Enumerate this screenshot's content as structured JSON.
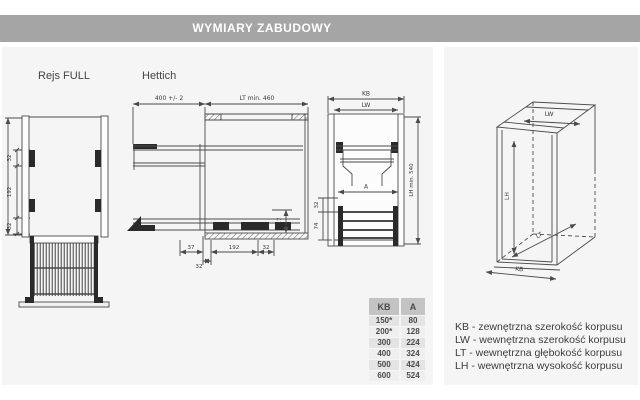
{
  "header": {
    "title": "WYMIARY ZABUDOWY"
  },
  "sections": {
    "left_label": "Rejs FULL",
    "middle_label": "Hettich"
  },
  "dims": {
    "rejs": {
      "v1": "32",
      "v2": "192",
      "v3": "32"
    },
    "side": {
      "extension": "400 +/- 2",
      "depth": "LT min. 460",
      "c1": "37",
      "c2": "32",
      "c3": "192",
      "c4": "32",
      "h": "17"
    },
    "front": {
      "kb": "KB",
      "lw": "LW",
      "lh": "LH min. 540",
      "a": "A",
      "s1": "32",
      "s2": "74"
    },
    "iso": {
      "lw": "LW",
      "lh": "LH",
      "lt": "LT",
      "kb": "KB"
    }
  },
  "table": {
    "headers": [
      "KB",
      "A"
    ],
    "rows": [
      [
        "150*",
        "80"
      ],
      [
        "200*",
        "128"
      ],
      [
        "300",
        "224"
      ],
      [
        "400",
        "324"
      ],
      [
        "500",
        "424"
      ],
      [
        "600",
        "524"
      ]
    ]
  },
  "legend": {
    "lines": [
      "KB - zewnętrzna szerokość korpusu",
      "LW - wewnętrzna szerokość korpusu",
      "LT - wewnętrzna głębokość korpusu",
      "LH - wewnętrzna wysokość korpusu"
    ]
  }
}
